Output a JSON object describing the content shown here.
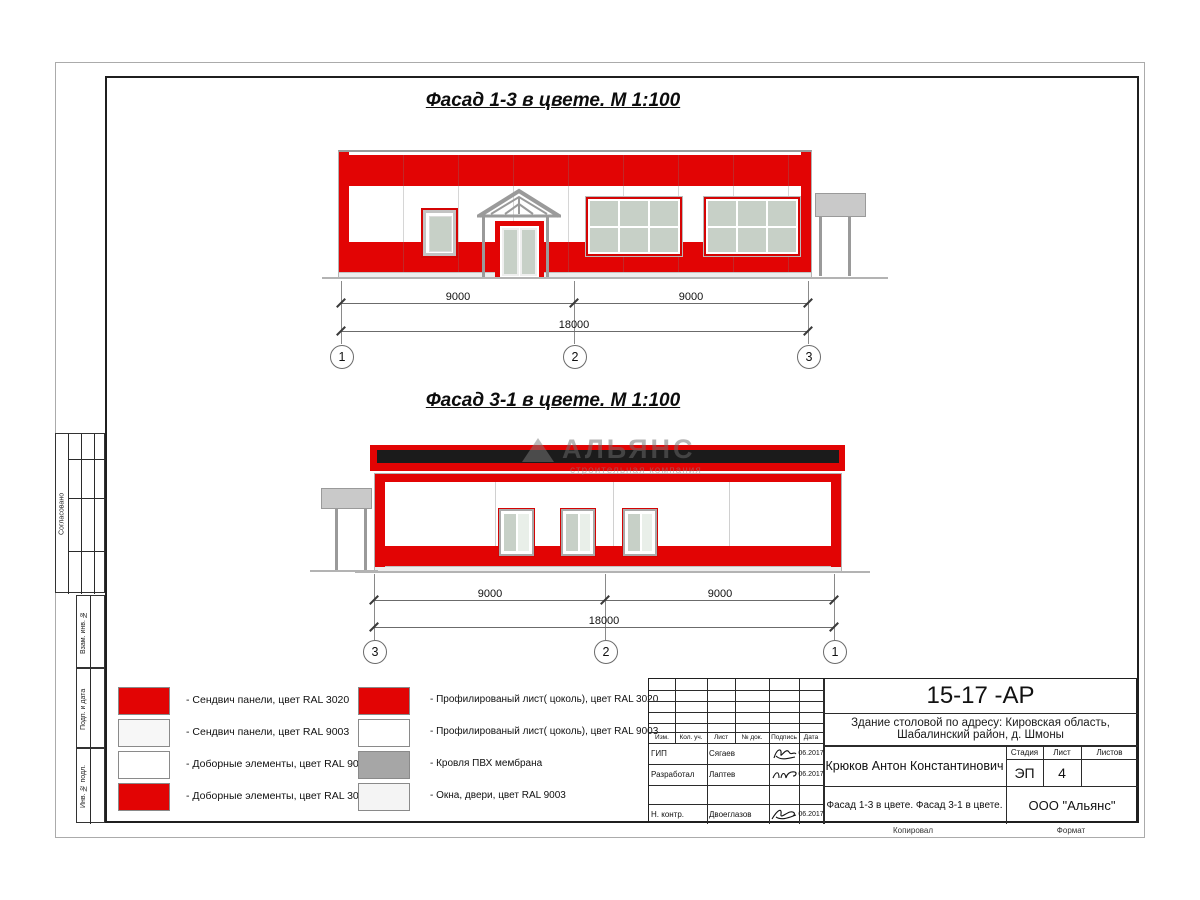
{
  "titles": {
    "facade_1_3": "Фасад 1-3 в цвете.  М 1:100",
    "facade_3_1": "Фасад 3-1 в цвете.  М 1:100"
  },
  "dimensions": {
    "facade_1_3": {
      "left": "9000",
      "right": "9000",
      "total": "18000",
      "axes": [
        "1",
        "2",
        "3"
      ]
    },
    "facade_3_1": {
      "left": "9000",
      "right": "9000",
      "total": "18000",
      "axes": [
        "3",
        "2",
        "1"
      ]
    }
  },
  "watermark": {
    "name": "АЛЬЯНС",
    "tagline": "строительная компания"
  },
  "legend": {
    "column1": [
      {
        "label": "- Сендвич панели, цвет RAL 3020",
        "color": "#e20404"
      },
      {
        "label": "- Сендвич панели, цвет RAL 9003",
        "color": "#f7f7f7"
      },
      {
        "label": "- Доборные элементы, цвет RAL 9003",
        "color": "#ffffff"
      },
      {
        "label": "- Доборные элементы, цвет RAL 3020",
        "color": "#e20404"
      }
    ],
    "column2": [
      {
        "label": "- Профилированый лист( цоколь), цвет RAL 3020",
        "color": "#e20404"
      },
      {
        "label": "- Профилированый лист( цоколь), цвет RAL 9003",
        "color": "#ffffff"
      },
      {
        "label": "- Кровля ПВХ мембрана",
        "color": "#a6a6a6"
      },
      {
        "label": "- Окна, двери, цвет RAL 9003",
        "color": "#f4f4f4"
      }
    ]
  },
  "sidebar": {
    "agreed": "Согласовано",
    "stamps": [
      "Взам. инв. №",
      "Подп. и дата",
      "Инв. № подл."
    ]
  },
  "title_block": {
    "doc_number": "15-17 -АР",
    "project": {
      "line1": "Здание столовой по адресу: Кировская область,",
      "line2": "Шабалинский район, д. Шмоны"
    },
    "header_cols": [
      "Изм.",
      "Кол. уч.",
      "Лист",
      "№ док.",
      "Подпись",
      "Дата"
    ],
    "rows": [
      {
        "role": "ГИП",
        "name": "Сягаев",
        "date": "06.2017"
      },
      {
        "role": "Разработал",
        "name": "Лаптев",
        "date": "06.2017"
      },
      {
        "role": "Н. контр.",
        "name": "Двоеглазов",
        "date": "06.2017"
      }
    ],
    "chief": "Крюков Антон Константинович",
    "stage_label": "Стадия",
    "sheet_label": "Лист",
    "sheets_label": "Листов",
    "stage": "ЭП",
    "sheet_num": "4",
    "sheets_total": "",
    "sheet_title": "Фасад 1-3 в цвете. Фасад 3-1 в цвете.",
    "company": "ООО \"Альянс\"",
    "copied_label": "Копировал",
    "format_label": "Формат"
  },
  "colors": {
    "ral3020_red": "#e20404",
    "ral9003_white": "#f7f7f7",
    "membrane_gray": "#a6a6a6",
    "windows_doors_gray": "#f4f4f4",
    "glass_green": "#c7d0c7",
    "roof_black": "#1b1b1b"
  }
}
